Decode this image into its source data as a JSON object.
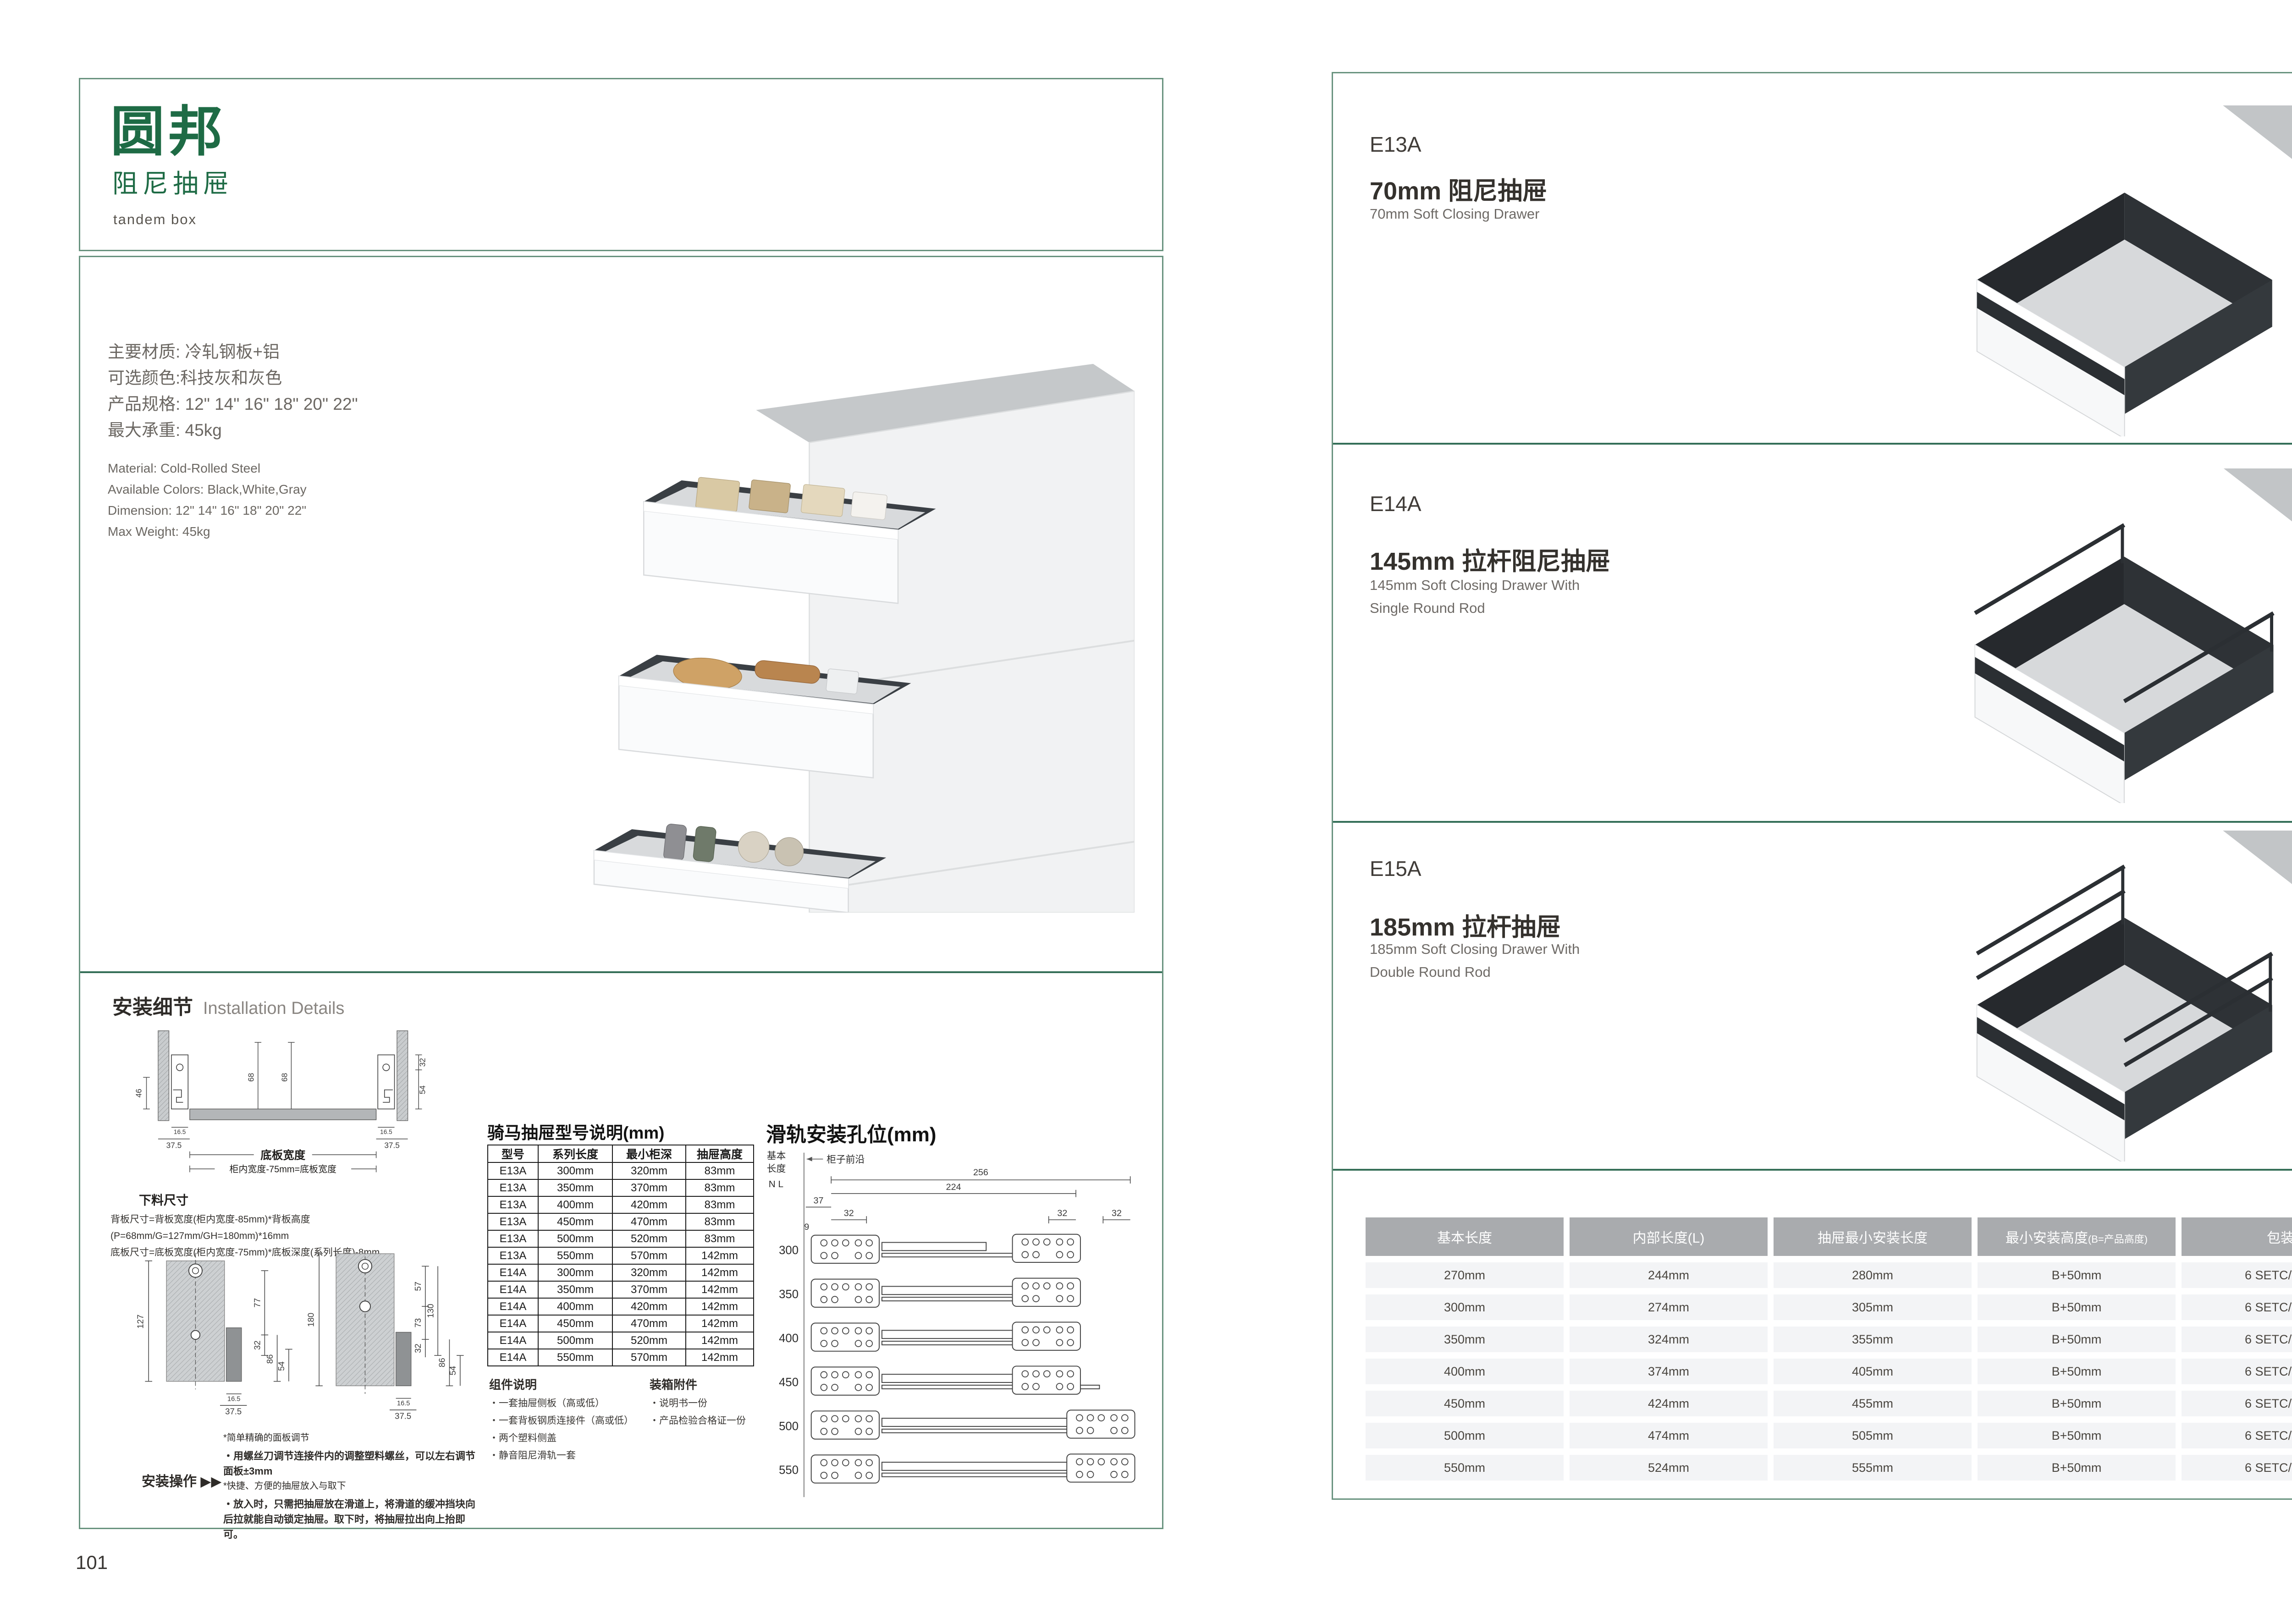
{
  "colors": {
    "accent_green": "#1e6b45",
    "border_green": "#69937f",
    "separator_green": "#356f58",
    "table_header_bg": "#a9abae",
    "table_row_bg": "#f3f4f6",
    "drawer_dark": "#2e3236",
    "counter_gray": "#c2c5c7"
  },
  "page_left": {
    "page_number": "101",
    "logo": {
      "brand": "圆邦",
      "subtitle": "阻尼抽屉",
      "tagline": "tandem box"
    },
    "specs_cn": [
      "主要材质: 冷轧钢板+铝",
      "可选颜色:科技灰和灰色",
      "产品规格: 12\" 14\" 16\" 18\" 20\" 22\"",
      "最大承重: 45kg"
    ],
    "specs_en": [
      "Material: Cold-Rolled Steel",
      "Available Colors: Black,White,Gray",
      "Dimension: 12\" 14\" 16\" 18\" 20\" 22\"",
      "Max Weight: 45kg"
    ],
    "installation": {
      "title_cn": "安装细节",
      "title_en": "Installation Details",
      "diagram1": {
        "label1": "底板宽度",
        "label2": "柜内宽度-75mm=底板宽度",
        "d46": "46",
        "d68a": "68",
        "d68b": "68",
        "d32": "32",
        "d54": "54",
        "d165a": "16.5",
        "d375a": "37.5",
        "d165b": "16.5",
        "d375b": "37.5"
      },
      "cutting": {
        "title": "下料尺寸",
        "line1": "背板尺寸=背板宽度(柜内宽度-85mm)*背板高度(P=68mm/G=127mm/GH=180mm)*16mm",
        "line2": "底板尺寸=底板宽度(柜内宽度-75mm)*底板深度(系列长度)-8mm"
      },
      "profile_left": {
        "d127": "127",
        "d77": "77",
        "d32": "32",
        "d86": "86",
        "d54": "54",
        "d165": "16.5",
        "d375": "37.5"
      },
      "profile_right": {
        "d180": "180",
        "d57": "57",
        "d73": "73",
        "d130": "130",
        "d32": "32",
        "d86": "86",
        "d54": "54",
        "d165": "16.5",
        "d375": "37.5"
      },
      "operation": {
        "label": "安装操作",
        "arrows": "▶▶",
        "bullets": [
          "*简单精确的面板调节",
          "・用螺丝刀调节连接件内的调整塑料螺丝，可以左右调节面板±3mm",
          "*快捷、方便的抽屉放入与取下",
          "・放入时，只需把抽屉放在滑道上，将滑道的缓冲挡块向后拉就能自动锁定抽屉。取下时，将抽屉拉出向上抬即可。"
        ]
      }
    },
    "model_table": {
      "title": "骑马抽屉型号说明(mm)",
      "headers": [
        "型号",
        "系列长度",
        "最小柜深",
        "抽屉高度"
      ],
      "rows": [
        [
          "E13A",
          "300mm",
          "320mm",
          "83mm"
        ],
        [
          "E13A",
          "350mm",
          "370mm",
          "83mm"
        ],
        [
          "E13A",
          "400mm",
          "420mm",
          "83mm"
        ],
        [
          "E13A",
          "450mm",
          "470mm",
          "83mm"
        ],
        [
          "E13A",
          "500mm",
          "520mm",
          "83mm"
        ],
        [
          "E13A",
          "550mm",
          "570mm",
          "142mm"
        ],
        [
          "E14A",
          "300mm",
          "320mm",
          "142mm"
        ],
        [
          "E14A",
          "350mm",
          "370mm",
          "142mm"
        ],
        [
          "E14A",
          "400mm",
          "420mm",
          "142mm"
        ],
        [
          "E14A",
          "450mm",
          "470mm",
          "142mm"
        ],
        [
          "E14A",
          "500mm",
          "520mm",
          "142mm"
        ],
        [
          "E14A",
          "550mm",
          "570mm",
          "142mm"
        ]
      ]
    },
    "components": {
      "title": "组件说明",
      "items": [
        "・一套抽屉侧板（高或低）",
        "・一套背板钢质连接件（高或低）",
        "・两个塑料侧盖",
        "・静音阻尼滑轨一套"
      ]
    },
    "packing": {
      "title": "装箱附件",
      "items": [
        "・说明书一份",
        "・产品检验合格证一份"
      ]
    },
    "rail_diagram": {
      "title": "滑轨安装孔位(mm)",
      "axis1": "基本",
      "axis2": "长度",
      "axis3": "N L",
      "front_edge": "柜子前沿",
      "d256": "256",
      "d224": "224",
      "d37": "37",
      "d9": "9",
      "d32a": "32",
      "d32b": "32",
      "d32c": "32",
      "lengths": [
        "300",
        "350",
        "400",
        "450",
        "500",
        "550"
      ]
    }
  },
  "page_right": {
    "page_number": "102",
    "products": [
      {
        "code": "E13A",
        "title_cn": "70mm 阻尼抽屉",
        "en1": "70mm Soft Closing Drawer",
        "en2": ""
      },
      {
        "code": "E14A",
        "title_cn": "145mm 拉杆阻尼抽屉",
        "en1": "145mm Soft Closing Drawer With",
        "en2": "Single Round Rod"
      },
      {
        "code": "E15A",
        "title_cn": "185mm 拉杆抽屉",
        "en1": "185mm Soft Closing Drawer With",
        "en2": "Double Round Rod"
      }
    ],
    "size_table": {
      "headers": [
        "基本长度",
        "内部长度(L)",
        "抽屉最小安装长度",
        "最小安装高度",
        "包装"
      ],
      "header4_note": "(B=产品高度)",
      "rows": [
        [
          "270mm",
          "244mm",
          "280mm",
          "B+50mm",
          "6 SETC/TNB"
        ],
        [
          "300mm",
          "274mm",
          "305mm",
          "B+50mm",
          "6 SETC/TNB"
        ],
        [
          "350mm",
          "324mm",
          "355mm",
          "B+50mm",
          "6 SETC/TNB"
        ],
        [
          "400mm",
          "374mm",
          "405mm",
          "B+50mm",
          "6 SETC/TNB"
        ],
        [
          "450mm",
          "424mm",
          "455mm",
          "B+50mm",
          "6 SETC/TNB"
        ],
        [
          "500mm",
          "474mm",
          "505mm",
          "B+50mm",
          "6 SETC/TNB"
        ],
        [
          "550mm",
          "524mm",
          "555mm",
          "B+50mm",
          "6 SETC/TNB"
        ]
      ]
    }
  }
}
